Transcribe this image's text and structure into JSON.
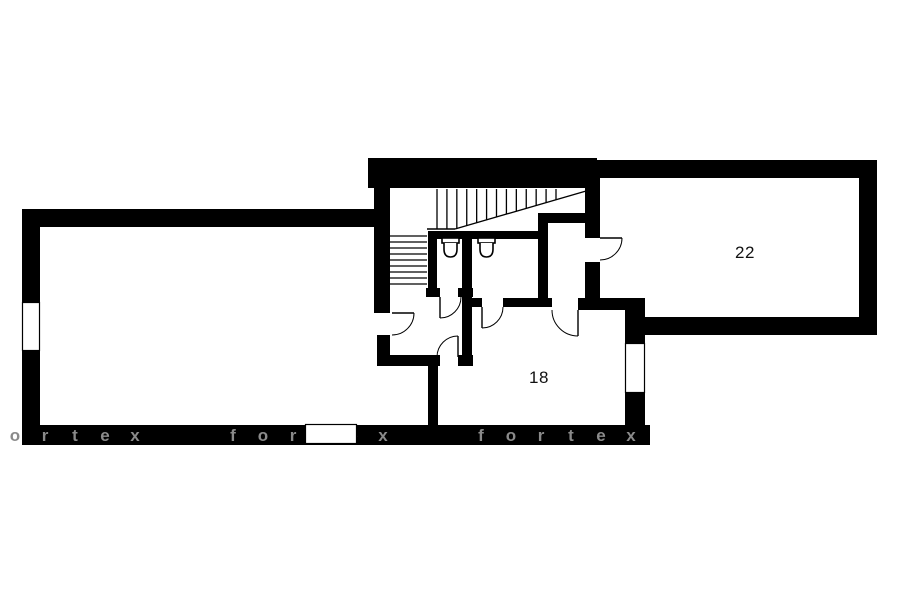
{
  "plan": {
    "canvas": {
      "w": 900,
      "h": 604
    },
    "colors": {
      "wall": "#000000",
      "background": "#ffffff",
      "line": "#000000",
      "watermark": "#8a8a8a"
    },
    "rooms": [
      {
        "label": "22",
        "x": 745,
        "y": 253
      },
      {
        "label": "18",
        "x": 539,
        "y": 378
      }
    ],
    "watermark": {
      "text": "fortex",
      "sets_x": [
        -15,
        233,
        481
      ],
      "spacing": 30,
      "baseline_y": 441,
      "font_size": 17
    },
    "walls": [
      [
        22,
        209,
        18,
        93
      ],
      [
        22,
        351,
        18,
        94
      ],
      [
        22,
        209,
        358,
        18
      ],
      [
        22,
        425,
        628,
        20
      ],
      [
        368,
        158,
        229,
        30
      ],
      [
        595,
        160,
        282,
        18
      ],
      [
        859,
        160,
        18,
        175
      ],
      [
        628,
        317,
        249,
        18
      ],
      [
        625,
        300,
        20,
        43
      ],
      [
        625,
        393,
        20,
        34
      ],
      [
        374,
        160,
        16,
        153
      ],
      [
        377,
        335,
        13,
        24
      ],
      [
        377,
        355,
        63,
        11
      ],
      [
        458,
        355,
        15,
        11
      ],
      [
        428,
        357,
        10,
        70
      ],
      [
        428,
        231,
        120,
        8
      ],
      [
        428,
        231,
        9,
        66
      ],
      [
        426,
        288,
        14,
        9
      ],
      [
        458,
        288,
        15,
        9
      ],
      [
        462,
        231,
        10,
        134
      ],
      [
        538,
        213,
        10,
        87
      ],
      [
        538,
        213,
        59,
        10
      ],
      [
        472,
        298,
        10,
        9
      ],
      [
        503,
        298,
        49,
        9
      ],
      [
        578,
        298,
        67,
        12
      ],
      [
        585,
        178,
        15,
        60
      ],
      [
        585,
        262,
        15,
        38
      ]
    ],
    "windows": [
      [
        22,
        302,
        18,
        49
      ],
      [
        305,
        424,
        52,
        20
      ],
      [
        625,
        343,
        20,
        50
      ]
    ],
    "doors": [
      {
        "h": [
          392,
          313
        ],
        "r": 22,
        "leaf": "E",
        "to": "S"
      },
      {
        "h": [
          458,
          357
        ],
        "r": 21,
        "leaf": "N",
        "to": "W"
      },
      {
        "h": [
          440,
          297
        ],
        "r": 21,
        "leaf": "S",
        "to": "E"
      },
      {
        "h": [
          482,
          307
        ],
        "r": 21,
        "leaf": "S",
        "to": "E"
      },
      {
        "h": [
          578,
          310
        ],
        "r": 26,
        "leaf": "S",
        "to": "W"
      },
      {
        "h": [
          600,
          238
        ],
        "r": 22,
        "leaf": "E",
        "to": "S"
      }
    ],
    "stairs": {
      "upper": {
        "tread_count": 13,
        "x_start": 437,
        "x_end": 556,
        "y_top": 189,
        "base_y": 229,
        "diag": [
          455,
          229,
          593,
          189
        ],
        "base_line": [
          427,
          229,
          455,
          229
        ]
      },
      "lower": {
        "tread_count": 9,
        "y_start": 236,
        "y_end": 284,
        "x_left": 390,
        "x_right": 427
      }
    },
    "toilets": [
      {
        "x": 442,
        "y": 238
      },
      {
        "x": 478,
        "y": 238
      }
    ],
    "toilet_size": {
      "w": 17,
      "h": 19
    }
  }
}
